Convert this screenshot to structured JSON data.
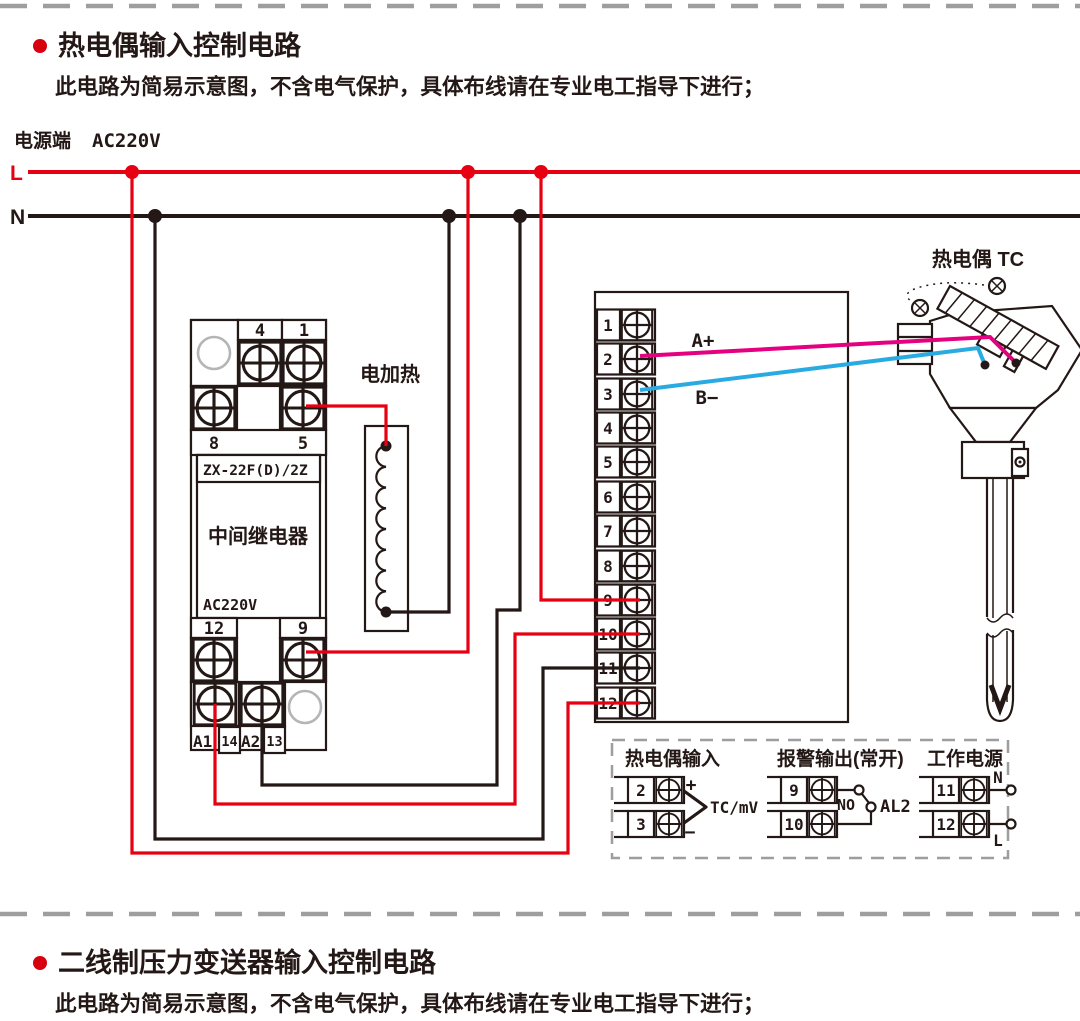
{
  "colors": {
    "wire_live_red": "#e60012",
    "wire_neutral_black": "#231815",
    "wire_tc_positive_magenta": "#e4007f",
    "wire_tc_negative_blue": "#29abe2",
    "bullet_red": "#d7000f",
    "dash_gray": "#9e9e9e"
  },
  "sections": {
    "top": {
      "title": "热电偶输入控制电路",
      "subtitle": "此电路为简易示意图，不含电气保护，具体布线请在专业电工指导下进行；"
    },
    "bottom": {
      "title": "二线制压力变送器输入控制电路",
      "subtitle": "此电路为简易示意图，不含电气保护，具体布线请在专业电工指导下进行；"
    }
  },
  "power": {
    "label": "电源端",
    "voltage": "AC220V",
    "live": "L",
    "neutral": "N"
  },
  "relay": {
    "model": "ZX-22F(D)/2Z",
    "name": "中间继电器",
    "voltage": "AC220V",
    "terminals": {
      "t4": "4",
      "t1": "1",
      "t8": "8",
      "t5": "5",
      "t12": "12",
      "t9": "9",
      "a1": "A1",
      "t14": "14",
      "a2": "A2",
      "t13": "13"
    }
  },
  "heater": {
    "label": "电加热"
  },
  "controller": {
    "terminals": [
      "1",
      "2",
      "3",
      "4",
      "5",
      "6",
      "7",
      "8",
      "9",
      "10",
      "11",
      "12"
    ],
    "wire_a_label": "A+",
    "wire_b_label": "B−"
  },
  "thermocouple": {
    "label": "热电偶 TC"
  },
  "legend": {
    "tc_input": {
      "title": "热电偶输入",
      "t2": "2",
      "t3": "3",
      "plus": "+",
      "minus": "−",
      "signal": "TC/mV"
    },
    "alarm": {
      "title": "报警输出(常开)",
      "t9": "9",
      "t10": "10",
      "contact": "NO",
      "name": "AL2"
    },
    "supply": {
      "title": "工作电源",
      "t11": "11",
      "t12": "12",
      "n": "N",
      "l": "L"
    }
  }
}
